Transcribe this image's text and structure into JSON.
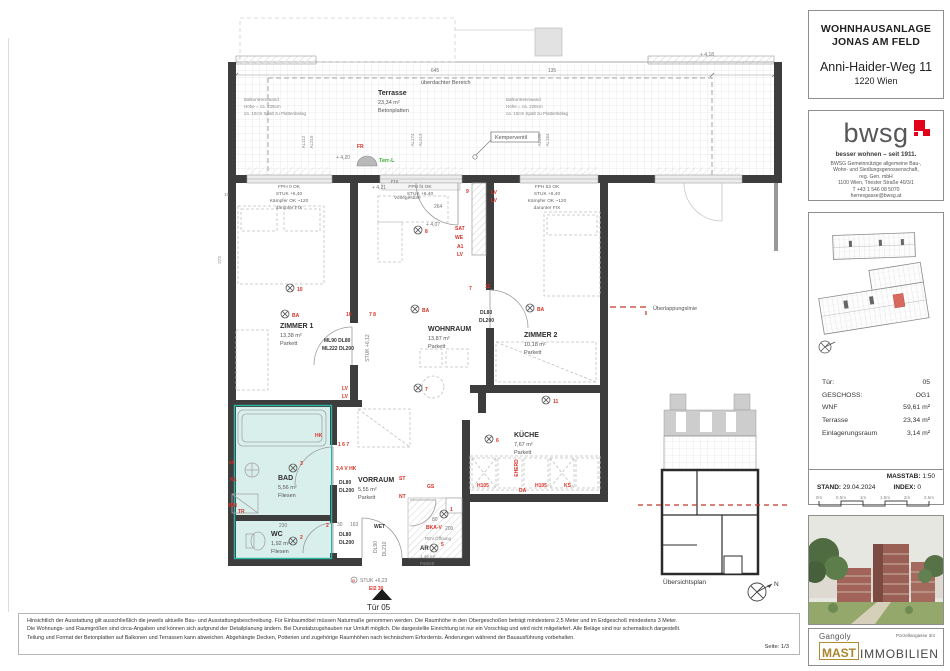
{
  "header": {
    "project_line1": "WOHNHAUSANLAGE",
    "project_line2": "JONAS AM FELD",
    "street": "Anni-Haider-Weg 11",
    "city": "1220 Wien"
  },
  "bwsg": {
    "wordmark": "bwsg",
    "tagline": "besser wohnen – seit 1911.",
    "address_lines": [
      "BWSG Gemeinnützige allgemeine Bau-,",
      "Wohn- und Siedlungsgenossenschaft,",
      "reg. Gen. mbH",
      "1100 Wien, Triester Straße 40/3/1",
      "T +43 1 546 08 5070",
      "herresgasse@bwsg.at"
    ]
  },
  "info": {
    "rows": [
      {
        "label": "Tür:",
        "value": "05"
      },
      {
        "label": "GESCHOSS:",
        "value": "OG1"
      },
      {
        "label": "WNF",
        "value": "59,61 m²"
      },
      {
        "label": "Terrasse",
        "value": "23,34 m²"
      },
      {
        "label": "Einlagerungsraum",
        "value": "3,14 m²"
      }
    ],
    "masstab_label": "MASSTAB:",
    "masstab_value": "1:50",
    "stand_label": "STAND:",
    "stand_value": "29.04.2024",
    "index_label": "INDEX:",
    "index_value": "0",
    "scale_ticks": [
      "0m",
      "0.5m",
      "1m",
      "1.5m",
      "2m",
      "2.5m"
    ]
  },
  "partners": {
    "architect": "Gangoly",
    "architect_address": "Porzellangasse 3/4",
    "mast": "MAST",
    "immobilien": "IMMOBILIEN"
  },
  "footer": {
    "l1": "Hinsichtlich der Ausstattung gilt ausschließlich die jeweils aktuelle Bau- und Ausstattungsbeschreibung. Für Einbaumöbel müssen Naturmaße genommen werden. Die Raumhöhe in den Obergeschoßen beträgt mindestens 2,5 Meter und im Erdgeschoß mindestens 3 Meter.",
    "l2": "Die Wohnungs- und Raumgrößen sind circa-Angaben und können sich aufgrund der Detailplanung ändern. Bei Dunstabzugshauben nur Umluft möglich. Die dargestellte Einrichtung ist nur ein Vorschlag und wird nicht mitgeliefert. Alle Beläge sind nur schematisch dargestellt.",
    "l3": "Teilung und Format der Betonplatten auf Balkonen und Terrassen kann abweichen. Abgehängte Decken, Potterien und zugehörige Raumhöhen nach technischem Erfordernis. Änderungen während der Bauausführung vorbehalten.",
    "page": "Seite: 1/3"
  },
  "overview": {
    "caption": "Übersichtsplan"
  },
  "plan": {
    "labels": {
      "terrasse": "Terrasse",
      "terrasse_area": "23,34 m²",
      "betonplatten": "Betonplatten",
      "ueberdachter": "überdachter Bereich",
      "balk1": "Balkontrennwand",
      "balk2": "Höhe = ca. 228cm",
      "balk3": "ca. 10cm Spalt zu Plattenbelag",
      "kemperventil": "Kemperventil",
      "fr": "FR",
      "terr_l": "Terr-L",
      "p420": "+ 4,20",
      "p421": "+ 4,21",
      "p418": "+ 4,18",
      "p407": "+ 4,07",
      "d645": "645",
      "d135": "135",
      "d264": "264",
      "d80": "80",
      "d200": "200",
      "d30": "30",
      "d163": "163",
      "d230": "230",
      "d273": "273",
      "d15": "15",
      "al112": "AL112",
      "al216": "AL216",
      "al174": "AL174",
      "al213": "AL213",
      "al108": "AL108",
      "al164": "AL164",
      "fph0": "FPH 0  OK",
      "fphf4": "FPH f4  OK",
      "fph62": "FPH 62  OK",
      "stuk640": "STUK +6,40",
      "kaempfer": "Kämpfer OK ~120",
      "darunter": "darunter FIX",
      "fix": "FIX",
      "vorlegestufe": "Vorlegestufe",
      "zimmer1": "ZIMMER 1",
      "zimmer1_area": "13,38 m²",
      "wohnraum": "WOHNRAUM",
      "wohnraum_area": "13,87 m²",
      "zimmer2": "ZIMMER 2",
      "zimmer2_area": "10,18 m²",
      "kueche": "KÜCHE",
      "kueche_area": "7,67 m²",
      "bad": "BAD",
      "bad_area": "5,56 m²",
      "vorraum": "VORRAUM",
      "vorraum_area": "5,55 m²",
      "wc": "WC",
      "wc_area": "1,92 m²",
      "ar": "AR",
      "ar_area": "1,49 m²",
      "parkett": "Parkett",
      "fliesen": "Fliesen",
      "ba": "BA",
      "lv": "LV",
      "sat": "SAT",
      "we": "WE",
      "a1": "A1",
      "hk": "HK",
      "g167": "1 6 7",
      "v34": "3,4 V  HK",
      "x4": "x4",
      "kl": "KL",
      "wm": "WM",
      "tr": "TR",
      "st": "ST",
      "nt": "NT",
      "gs": "GS",
      "eherd": "EHERD",
      "h105": "H105",
      "da": "DA",
      "ks": "KS",
      "bkav": "BKA-V",
      "rev": "REV.Öffnung",
      "gsym": "G",
      "ml_line1": "ML90  DL80",
      "ml_line2": "ML222 DL200",
      "dl80": "DL80",
      "dl200": "DL200",
      "dl90": "DL90",
      "dl210": "DL210",
      "wet": "WET",
      "stuk623": "STUK +6,23",
      "stuk612": "STUK +6,12",
      "ei230": "EI2 30",
      "tuer05": "Tür 05",
      "ueberlappung": "Überlappungslinie",
      "n1": "1",
      "n2": "2",
      "n3": "3",
      "n5": "5",
      "n6": "6",
      "n7": "7",
      "n8": "8",
      "n9": "9",
      "n10": "10",
      "n11": "11",
      "n78": "7 8",
      "north": "N"
    }
  },
  "colors": {
    "accent_red": "#d93025",
    "teal": "#2bb3a3",
    "bwsg_red": "#e2001a",
    "gold": "#b08d2f"
  }
}
